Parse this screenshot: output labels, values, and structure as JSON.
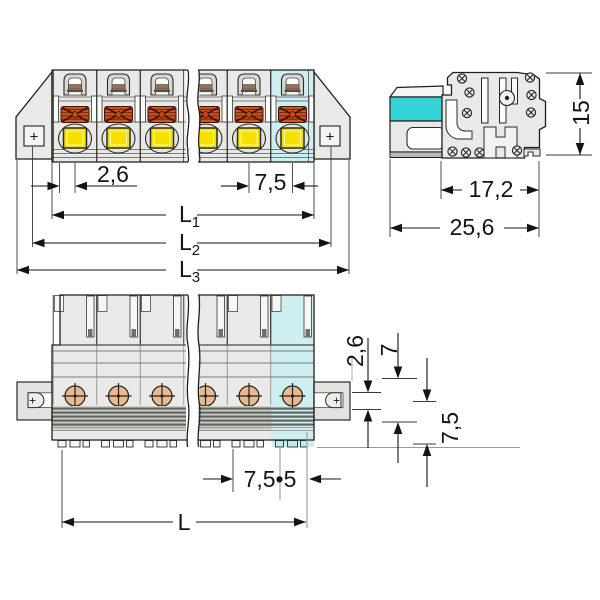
{
  "drawing_title": "connector-dimension-drawing",
  "front_view": {
    "dim_edge_offset": "2,6",
    "dim_pitch": "7,5",
    "dim_l1": {
      "base": "L",
      "sub": "1"
    },
    "dim_l2": {
      "base": "L",
      "sub": "2"
    },
    "dim_l3": {
      "base": "L",
      "sub": "3"
    }
  },
  "side_view": {
    "dim_height": "15",
    "dim_depth_body": "17,2",
    "dim_depth_total": "25,6"
  },
  "bottom_view": {
    "dim_rail_slot": "2,6",
    "dim_rail_width": "7",
    "dim_rail_offset": "7,5",
    "dim_pitch_count": "7,5•5",
    "dim_length": "L"
  },
  "markers": {
    "plus_front_left": "+",
    "plus_front_right": "+",
    "plus_bottom_left": "+",
    "plus_bottom_right": "+"
  },
  "colors": {
    "highlight_light": "#cfeef1",
    "highlight_strong": "#35d4d6",
    "button_yellow": "#f6e000",
    "screw_orange": "#cc5520",
    "screw_top_orange": "#eab98f",
    "body_gray": "#e9eae7"
  }
}
